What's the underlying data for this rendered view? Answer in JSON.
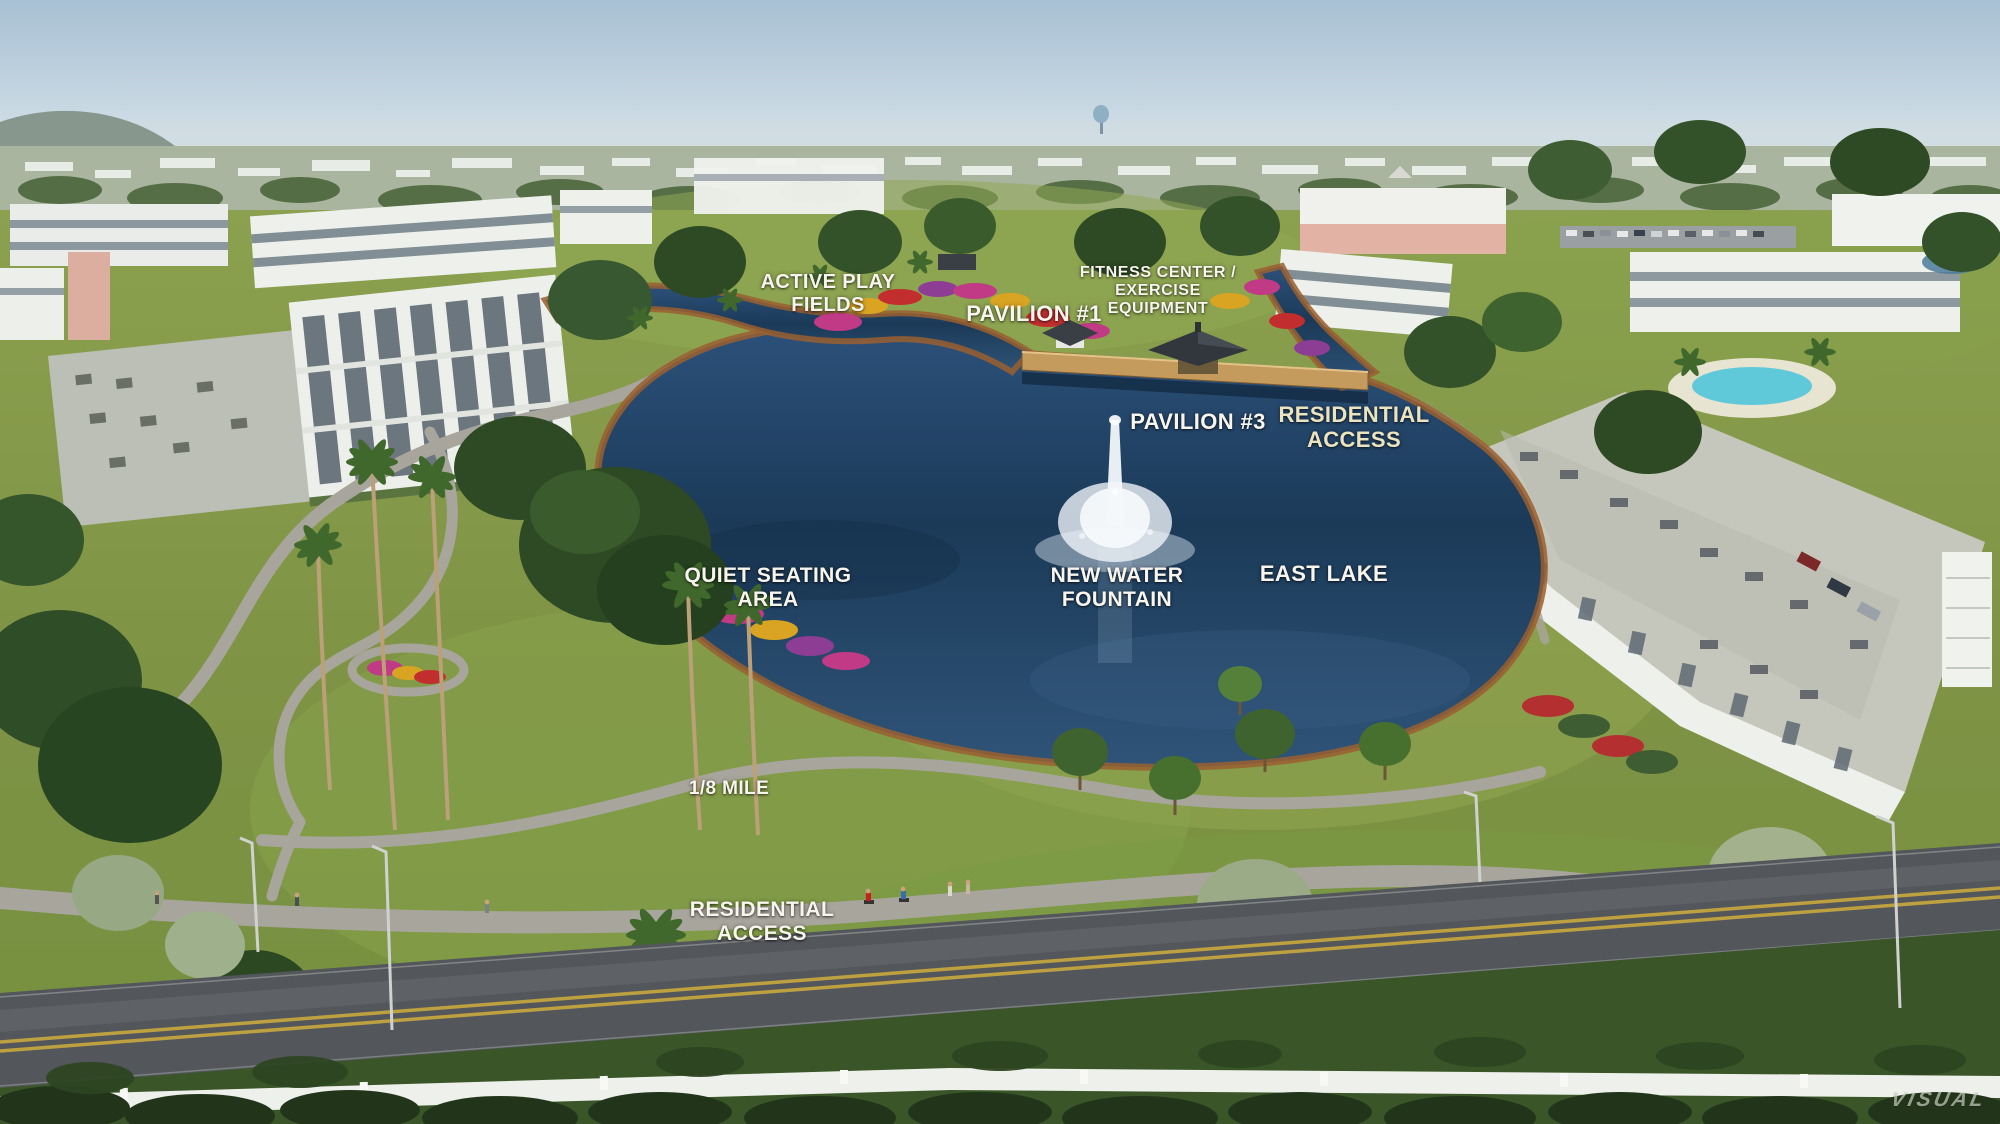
{
  "scene": {
    "watermark": "VISUAL"
  },
  "labels": {
    "active_play_fields": {
      "line1": "ACTIVE PLAY",
      "line2": "FIELDS"
    },
    "pavilion_1": {
      "line1": "PAVILION #1"
    },
    "fitness_center": {
      "line1": "FITNESS CENTER /",
      "line2": "EXERCISE",
      "line3": "EQUIPMENT"
    },
    "pavilion_3": {
      "line1": "PAVILION #3"
    },
    "residential_access_north": {
      "line1": "RESIDENTIAL",
      "line2": "ACCESS"
    },
    "quiet_seating_area": {
      "line1": "QUIET SEATING",
      "line2": "AREA"
    },
    "new_water_fountain": {
      "line1": "NEW WATER",
      "line2": "FOUNTAIN"
    },
    "east_lake": {
      "line1": "EAST LAKE"
    },
    "one_eighth_mile": {
      "line1": "1/8 MILE"
    },
    "residential_access_south": {
      "line1": "RESIDENTIAL",
      "line2": "ACCESS"
    }
  },
  "colors": {
    "sky_top": "#a7c0d3",
    "sky_horizon": "#dde7ec",
    "water_dark": "#1b3a58",
    "water_light": "#2f5478",
    "grass": "#7f9345",
    "grass_light": "#93a751",
    "mulch_edge": "#9a5f30",
    "path_gray": "#a8a69c",
    "road_asphalt": "#53565a",
    "road_line_yellow": "#c9a93e",
    "fence_white": "#eef0ec",
    "hedge_dark": "#22351b",
    "flower_magenta": "#c13a86",
    "flower_red": "#c22e2e",
    "flower_yellow": "#d9a422",
    "flower_purple": "#8e3d94",
    "building_white": "#eef0ec",
    "roof_gray": "#c6c7bc",
    "clubhouse_pink": "#e2b3a4",
    "pool_blue": "#5fc8d9",
    "fountain_white": "#f4f8fb",
    "label_white": "#f7f5ee",
    "label_cream": "#ece4c0"
  }
}
